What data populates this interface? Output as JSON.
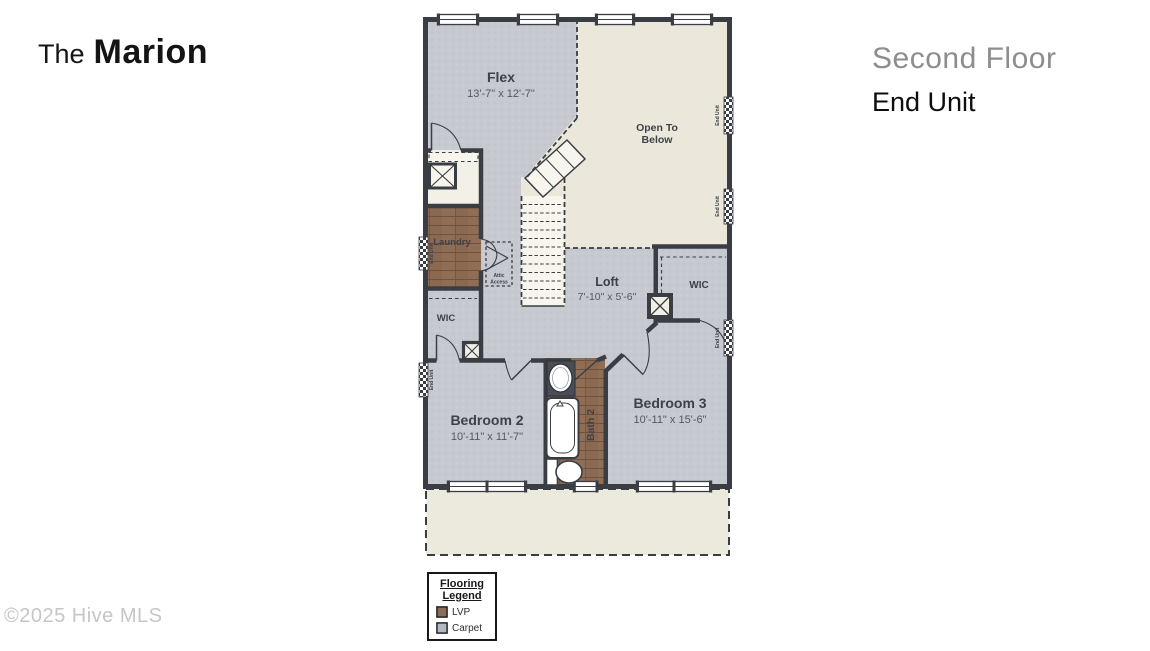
{
  "brand": {
    "prefix": "The",
    "name": "Marion"
  },
  "header": {
    "floor": "Second Floor",
    "unit": "End Unit"
  },
  "watermark": "©2025 Hive MLS",
  "plan": {
    "flex": {
      "name": "Flex",
      "dims": "13'-7\" x 12'-7\""
    },
    "open_to_below": {
      "line1": "Open To",
      "line2": "Below"
    },
    "laundry": {
      "name": "Laundry"
    },
    "attic_access": {
      "line1": "Attic",
      "line2": "Access"
    },
    "wic_left": {
      "name": "WIC"
    },
    "wic_right": {
      "name": "WIC"
    },
    "loft": {
      "name": "Loft",
      "dims": "7'-10\" x 5'-6\""
    },
    "bedroom2": {
      "name": "Bedroom 2",
      "dims": "10'-11\" x 11'-7\""
    },
    "bath2": {
      "name": "Bath 2"
    },
    "bedroom3": {
      "name": "Bedroom 3",
      "dims": "10'-11\" x 15'-6\""
    },
    "end_unit_wall_label": "End Unit"
  },
  "legend": {
    "title_line1": "Flooring",
    "title_line2": "Legend",
    "items": [
      {
        "label": "LVP",
        "color": "#8d6c55"
      },
      {
        "label": "Carpet",
        "color": "#b4b8bf"
      }
    ]
  },
  "colors": {
    "wall": "#3a3e44",
    "carpet": "#c6c9cf",
    "lvp": "#8b6950",
    "open_area": "#ebe8db",
    "title_gray": "#8d8d90",
    "text_dark": "#3d4148"
  }
}
